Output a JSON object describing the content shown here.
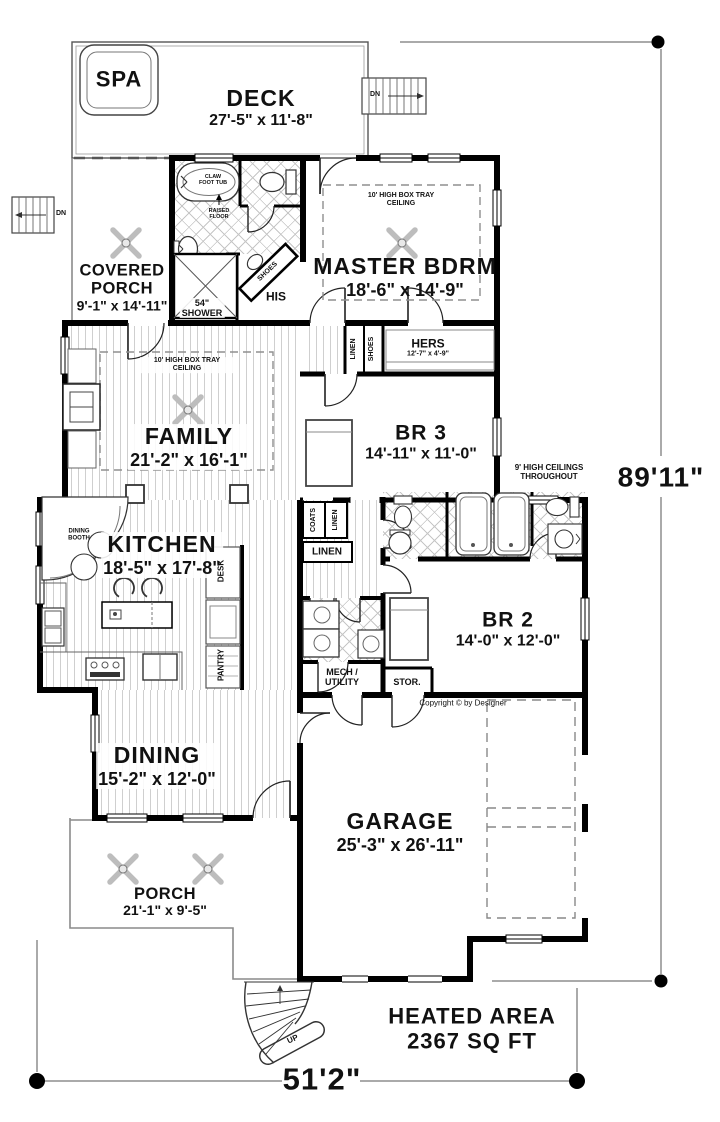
{
  "rooms": {
    "spa": {
      "name": "SPA"
    },
    "deck": {
      "name": "DECK",
      "dims": "27'-5\" x 11'-8\""
    },
    "covered_porch": {
      "name": "COVERED PORCH",
      "dims": "9'-1\" x 14'-11\""
    },
    "master": {
      "name": "MASTER BDRM",
      "dims": "18'-6\" x 14'-9\""
    },
    "hers": {
      "name": "HERS",
      "dims": "12'-7\" x 4'-9\""
    },
    "family": {
      "name": "FAMILY",
      "dims": "21'-2\" x 16'-1\""
    },
    "br3": {
      "name": "BR 3",
      "dims": "14'-11\" x 11'-0\""
    },
    "kitchen": {
      "name": "KITCHEN",
      "dims": "18'-5\" x 17'-8\""
    },
    "br2": {
      "name": "BR 2",
      "dims": "14'-0\" x 12'-0\""
    },
    "dining": {
      "name": "DINING",
      "dims": "15'-2\" x 12'-0\""
    },
    "garage": {
      "name": "GARAGE",
      "dims": "25'-3\" x 26'-11\""
    },
    "porch": {
      "name": "PORCH",
      "dims": "21'-1\" x 9'-5\""
    }
  },
  "closets": {
    "his": "HIS",
    "shoes": "SHOES",
    "linen": "LINEN",
    "coats": "COATS",
    "desk": "DESK",
    "pantry": "PANTRY",
    "stor": "STOR.",
    "mech_utility": "MECH / UTILITY"
  },
  "annotations": {
    "tray_ceiling": "10' HIGH BOX TRAY CEILING",
    "ceiling_note": "9' HIGH CEILINGS THROUGHOUT",
    "claw_tub": "CLAW FOOT TUB",
    "raised_floor": "RAISED FLOOR",
    "shower_size": "54\"",
    "shower_label": "SHOWER",
    "dining_booth": "DINING BOOTH",
    "dn": "DN",
    "up": "UP",
    "copyright": "Copyright © by Designer"
  },
  "dimensions": {
    "overall_depth": "89'11\"",
    "overall_width": "51'2\"",
    "heated_area_label": "HEATED AREA",
    "heated_area_value": "2367 SQ FT"
  }
}
